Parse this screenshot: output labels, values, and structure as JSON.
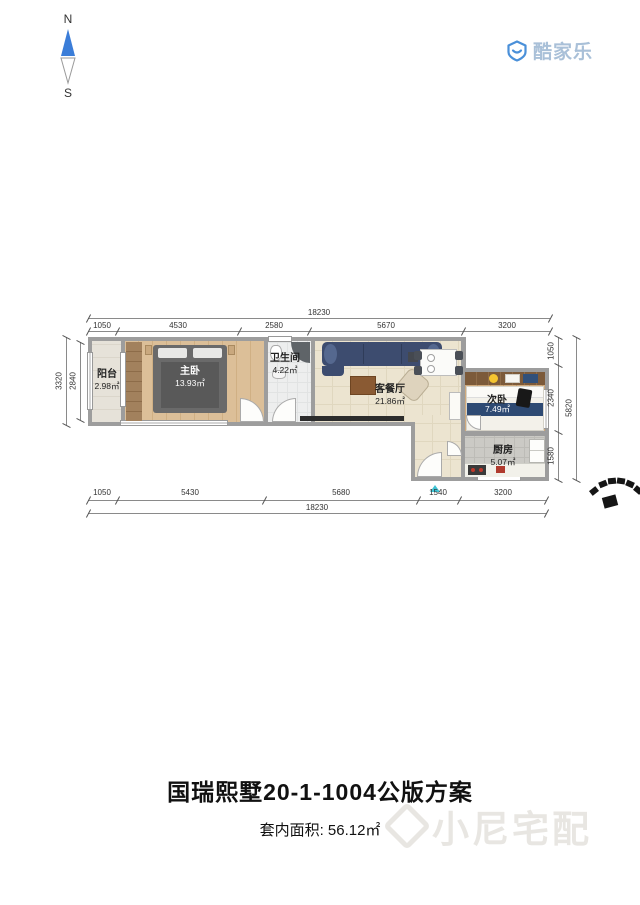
{
  "compass": {
    "north_label": "N",
    "south_label": "S"
  },
  "brand": {
    "logo_text": "酷家乐"
  },
  "floorplan": {
    "rooms": [
      {
        "name": "阳台",
        "area": "2.98㎡"
      },
      {
        "name": "主卧",
        "area": "13.93㎡"
      },
      {
        "name": "卫生间",
        "area": "4.22㎡"
      },
      {
        "name": "客餐厅",
        "area": "21.86㎡"
      },
      {
        "name": "次卧",
        "area": "7.49㎡"
      },
      {
        "name": "厨房",
        "area": "5.07㎡"
      }
    ],
    "dimensions_mm": {
      "top_total": "18230",
      "top_segments": [
        "1050",
        "4530",
        "2580",
        "5670",
        "3200"
      ],
      "bottom_total": "18230",
      "bottom_segments": [
        "1050",
        "5430",
        "5680",
        "1540",
        "3200"
      ],
      "left_total": "3320",
      "left_inner": "2840",
      "right_total": "5820",
      "right_segments": [
        "1050",
        "2340",
        "1580"
      ]
    }
  },
  "footer": {
    "title": "国瑞熙墅20-1-1004公版方案",
    "area_text": "套内面积: 56.12㎡",
    "watermark_text": "小尼宅配"
  },
  "colors": {
    "compass_blue": "#3b7dd8",
    "logo_blue": "#4a90d9",
    "logo_text": "#a9c0d8",
    "wall_gray": "#9d9d9d",
    "entry_marker_cyan": "#3fc3d4",
    "sofa_navy": "#3d4c6f",
    "bed2_navy": "#2e4a73",
    "wood_floor": "#dcbf98",
    "stamp_black": "#161616",
    "watermark_gray": "#e8e6e2"
  }
}
